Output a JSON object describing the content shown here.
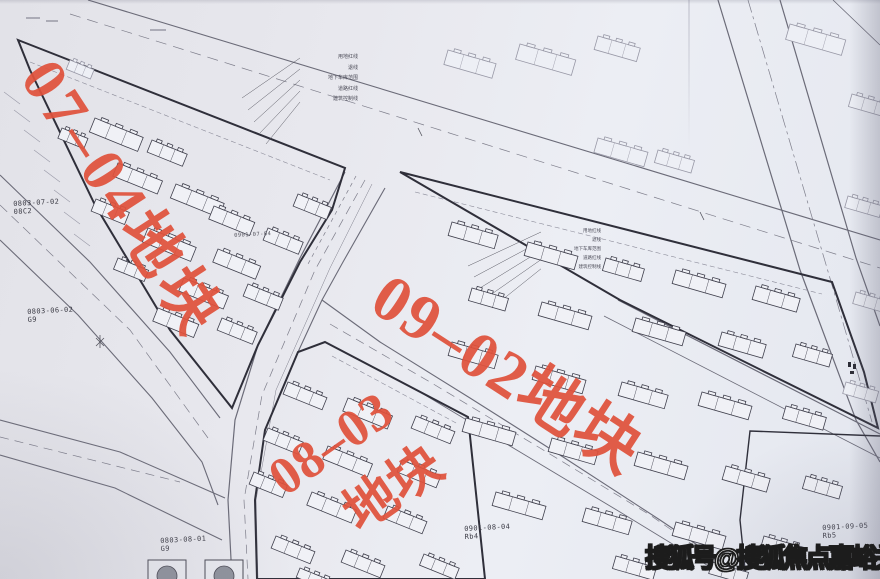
{
  "page": {
    "width": 880,
    "height": 579,
    "kind": "scanned urban planning site plan"
  },
  "colors": {
    "paper": "#e8e9ef",
    "red_label": "#e0523c",
    "boundary": "#2f2f3a",
    "road": "#6b6b78",
    "faint": "#9898a6",
    "watermark_fill": "#ffffff",
    "watermark_stroke": "#1c1c1c"
  },
  "watermark": {
    "text": "搜狐号@搜狐焦点嘉峪关站",
    "x": 645,
    "y": 538
  },
  "red_labels": [
    {
      "name": "plot-label-07-04",
      "text": "07–04地块",
      "x": 62,
      "y": 50,
      "rot": 57,
      "size": 62,
      "ls": 5
    },
    {
      "name": "plot-label-09-02",
      "text": "09–02地块",
      "x": 396,
      "y": 264,
      "rot": 33,
      "size": 65,
      "ls": 2
    },
    {
      "name": "plot-label-08-03-line1",
      "text": "08–03",
      "x": 260,
      "y": 462,
      "rot": -35,
      "size": 53,
      "ls": 1
    },
    {
      "name": "plot-label-08-03-line2",
      "text": "地块",
      "x": 335,
      "y": 498,
      "rot": -35,
      "size": 53,
      "ls": 0
    }
  ],
  "parcel_ids": [
    {
      "text": "0803-07-02",
      "sub": "08C2",
      "x": 13,
      "y": 200,
      "small": false
    },
    {
      "text": "0803-06-02",
      "sub": "G9",
      "x": 27,
      "y": 308,
      "small": false
    },
    {
      "text": "0803-08-01",
      "sub": "G9",
      "x": 160,
      "y": 537,
      "small": false
    },
    {
      "text": "0901-08-04",
      "sub": "Rb4",
      "x": 464,
      "y": 525,
      "small": false
    },
    {
      "text": "0901-09-05",
      "sub": "Rb5",
      "x": 822,
      "y": 524,
      "small": false
    },
    {
      "text": "0901-07-04",
      "sub": "",
      "x": 234,
      "y": 233,
      "small": true
    },
    {
      "text": "Rb",
      "sub": "",
      "x": 660,
      "y": 565,
      "small": true
    }
  ],
  "callouts": {
    "top": {
      "x": 288,
      "y0": 55,
      "labels": [
        "用地红线",
        "退线",
        "地下车库范围",
        "道路红线",
        "建筑控制线"
      ],
      "anchor_x": 300,
      "targets": [
        [
          242,
          98
        ],
        [
          248,
          110
        ],
        [
          254,
          122
        ],
        [
          260,
          133
        ],
        [
          266,
          144
        ]
      ]
    },
    "right": {
      "x": 540,
      "y0": 229,
      "labels": [
        "用地红线",
        "退线",
        "地下车库范围",
        "道路红线",
        "建筑控制线"
      ],
      "anchor_x": 541,
      "targets": [
        [
          468,
          266
        ],
        [
          474,
          277
        ],
        [
          480,
          288
        ],
        [
          486,
          298
        ],
        [
          492,
          308
        ]
      ]
    }
  },
  "buildings_main": [
    [
      95,
      118,
      52,
      15,
      22
    ],
    [
      152,
      140,
      38,
      13,
      22
    ],
    [
      118,
      163,
      48,
      14,
      22
    ],
    [
      176,
      184,
      52,
      15,
      22
    ],
    [
      96,
      199,
      36,
      13,
      22
    ],
    [
      214,
      206,
      44,
      14,
      22
    ],
    [
      148,
      228,
      52,
      15,
      22
    ],
    [
      218,
      249,
      46,
      14,
      22
    ],
    [
      118,
      258,
      33,
      12,
      22
    ],
    [
      184,
      278,
      48,
      14,
      22
    ],
    [
      248,
      284,
      38,
      13,
      22
    ],
    [
      158,
      308,
      44,
      14,
      22
    ],
    [
      222,
      318,
      38,
      13,
      22
    ],
    [
      268,
      228,
      38,
      13,
      22
    ],
    [
      298,
      194,
      36,
      13,
      22
    ],
    [
      62,
      128,
      28,
      11,
      22
    ],
    [
      452,
      222,
      48,
      14,
      16
    ],
    [
      528,
      242,
      52,
      14,
      16
    ],
    [
      606,
      258,
      40,
      13,
      16
    ],
    [
      676,
      270,
      52,
      14,
      16
    ],
    [
      756,
      286,
      46,
      14,
      16
    ],
    [
      472,
      288,
      38,
      13,
      16
    ],
    [
      542,
      302,
      52,
      14,
      16
    ],
    [
      636,
      318,
      52,
      14,
      16
    ],
    [
      722,
      332,
      46,
      14,
      16
    ],
    [
      796,
      344,
      38,
      13,
      16
    ],
    [
      452,
      342,
      48,
      14,
      16
    ],
    [
      536,
      366,
      52,
      14,
      16
    ],
    [
      622,
      382,
      48,
      14,
      16
    ],
    [
      702,
      392,
      52,
      14,
      16
    ],
    [
      786,
      406,
      42,
      13,
      16
    ],
    [
      466,
      418,
      52,
      14,
      16
    ],
    [
      552,
      438,
      48,
      14,
      16
    ],
    [
      638,
      452,
      52,
      14,
      16
    ],
    [
      726,
      466,
      46,
      14,
      16
    ],
    [
      806,
      476,
      38,
      13,
      16
    ],
    [
      496,
      492,
      52,
      14,
      16
    ],
    [
      586,
      508,
      48,
      14,
      16
    ],
    [
      676,
      522,
      52,
      14,
      16
    ],
    [
      764,
      536,
      42,
      13,
      16
    ],
    [
      616,
      556,
      42,
      13,
      16
    ],
    [
      712,
      562,
      38,
      12,
      16
    ],
    [
      288,
      382,
      42,
      13,
      22
    ],
    [
      348,
      398,
      48,
      14,
      22
    ],
    [
      416,
      416,
      42,
      13,
      22
    ],
    [
      268,
      428,
      38,
      13,
      22
    ],
    [
      328,
      446,
      48,
      14,
      22
    ],
    [
      402,
      460,
      42,
      13,
      22
    ],
    [
      254,
      472,
      36,
      13,
      22
    ],
    [
      312,
      492,
      48,
      14,
      22
    ],
    [
      388,
      506,
      42,
      13,
      22
    ],
    [
      276,
      536,
      42,
      13,
      22
    ],
    [
      346,
      550,
      42,
      13,
      22
    ],
    [
      424,
      554,
      38,
      12,
      22
    ],
    [
      300,
      568,
      36,
      10,
      22
    ]
  ],
  "buildings_faint": [
    [
      448,
      50,
      50,
      15,
      16
    ],
    [
      520,
      44,
      58,
      16,
      16
    ],
    [
      598,
      36,
      44,
      14,
      16
    ],
    [
      790,
      24,
      58,
      16,
      16
    ],
    [
      852,
      94,
      40,
      13,
      16
    ],
    [
      598,
      138,
      52,
      15,
      16
    ],
    [
      658,
      150,
      38,
      13,
      16
    ],
    [
      848,
      196,
      36,
      12,
      16
    ],
    [
      856,
      292,
      34,
      12,
      16
    ],
    [
      846,
      382,
      34,
      12,
      16
    ],
    [
      70,
      60,
      26,
      10,
      22
    ]
  ],
  "trees": [
    [
      148,
      560
    ],
    [
      205,
      560
    ]
  ]
}
